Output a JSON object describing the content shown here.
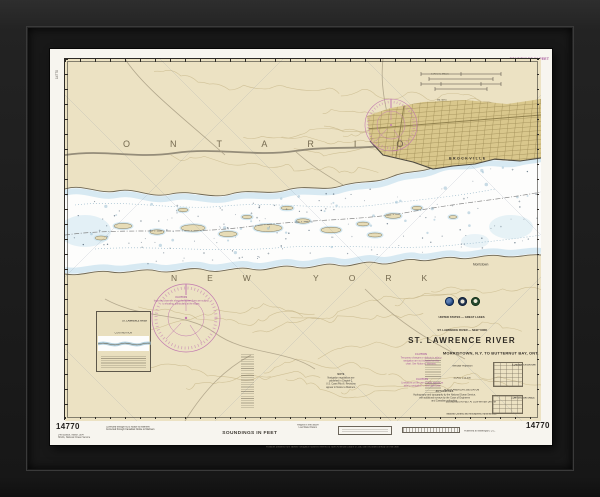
{
  "margins": {
    "top_center_note": "U.S. DEPARTMENT OF COMMERCE — NATIONAL OCEANIC AND ATMOSPHERIC ADMINISTRATION — NATIONAL OCEAN SERVICE",
    "top_right_soundings": "SOUNDINGS IN FEET",
    "left_vertical_number": "14770",
    "bottom": {
      "chart_number": "14770",
      "soundings": "SOUNDINGS IN FEET",
      "magenta_line1": "Corrected through NOS Notice to Mariners",
      "magenta_line2": "Corrected through Canadian Notice to Mariners",
      "edition_line1": "14th Edition, March 1994",
      "edition_line2": "NOAA, National Ocean Service",
      "center_line1": "Heights in feet above",
      "center_line2": "Low Water Datum",
      "published_note": "Published at Washington, D.C.",
      "footer_note": "Positions obtained from satellite navigation systems referred to North American Datum of 1983 can be plotted directly on this chart"
    }
  },
  "map": {
    "province_label": "ONTARIO",
    "state_label": "NEW YORK",
    "city_label": "BROCKVILLE",
    "town_label": "Morristown",
    "scalebar_top_label": "STATUTE MILES",
    "scalebar_bottom_label": "METERS"
  },
  "title_block": {
    "logos": [
      "noaa-logo",
      "commerce-seal",
      "nos-emblem"
    ],
    "line_country": "UNITED STATES — GREAT LAKES",
    "line_region": "ST. LAWRENCE RIVER — NEW YORK",
    "title": "ST. LAWRENCE RIVER",
    "subtitle": "MORRISTOWN, N.Y. TO BUTTERNUT BAY, ONT.",
    "projection_line": "Mercator Projection",
    "scale_line": "SCALE 1:15,000",
    "datum_line": "NORTH AMERICAN 1983 DATUM",
    "soundings_line": "SOUNDINGS IN FEET AT LOW WATER DATUM",
    "agency_line": "National Oceanic and Atmospheric Administration"
  },
  "notes": {
    "caution_upper": {
      "title": "CAUTION",
      "l1": "Improved channels shown by broken lines are subject",
      "l2": "to shoaling, particularly at the edges."
    },
    "caution_a": {
      "title": "CAUTION",
      "l1": "Temporary changes or defects in aids to",
      "l2": "navigation are not indicated on this",
      "l3": "chart. See Notice to Mariners."
    },
    "caution_b": {
      "title": "CAUTION",
      "l1": "Limitations on the use of radio signals as",
      "l2": "aids to navigation — see Light Lists."
    },
    "note_center": {
      "title": "NOTE",
      "l1": "Navigation regulations are",
      "l2": "published in Chapter 2,",
      "l3": "U.S. Coast Pilot 6. Revisions",
      "l4": "appear in Notice to Mariners."
    },
    "authorities": {
      "title": "AUTHORITIES",
      "l1": "Hydrography and topography by the National Ocean Service,",
      "l2": "with additional surveys by the Corps of Engineers",
      "l3": "and Canadian authorities."
    }
  },
  "inset": {
    "header_line": "ST. LAWRENCE RIVER",
    "sub_line": "CONTINUATION"
  },
  "tables": {
    "t1": "LOW WATER DATUM",
    "t2": "CONVERSION TABLE"
  },
  "colors": {
    "chart_magenta": "#a8599b",
    "land_tan": "#ece2c3",
    "shallow_blue": "#d3e7f1",
    "city_tan": "#d9c78c"
  }
}
